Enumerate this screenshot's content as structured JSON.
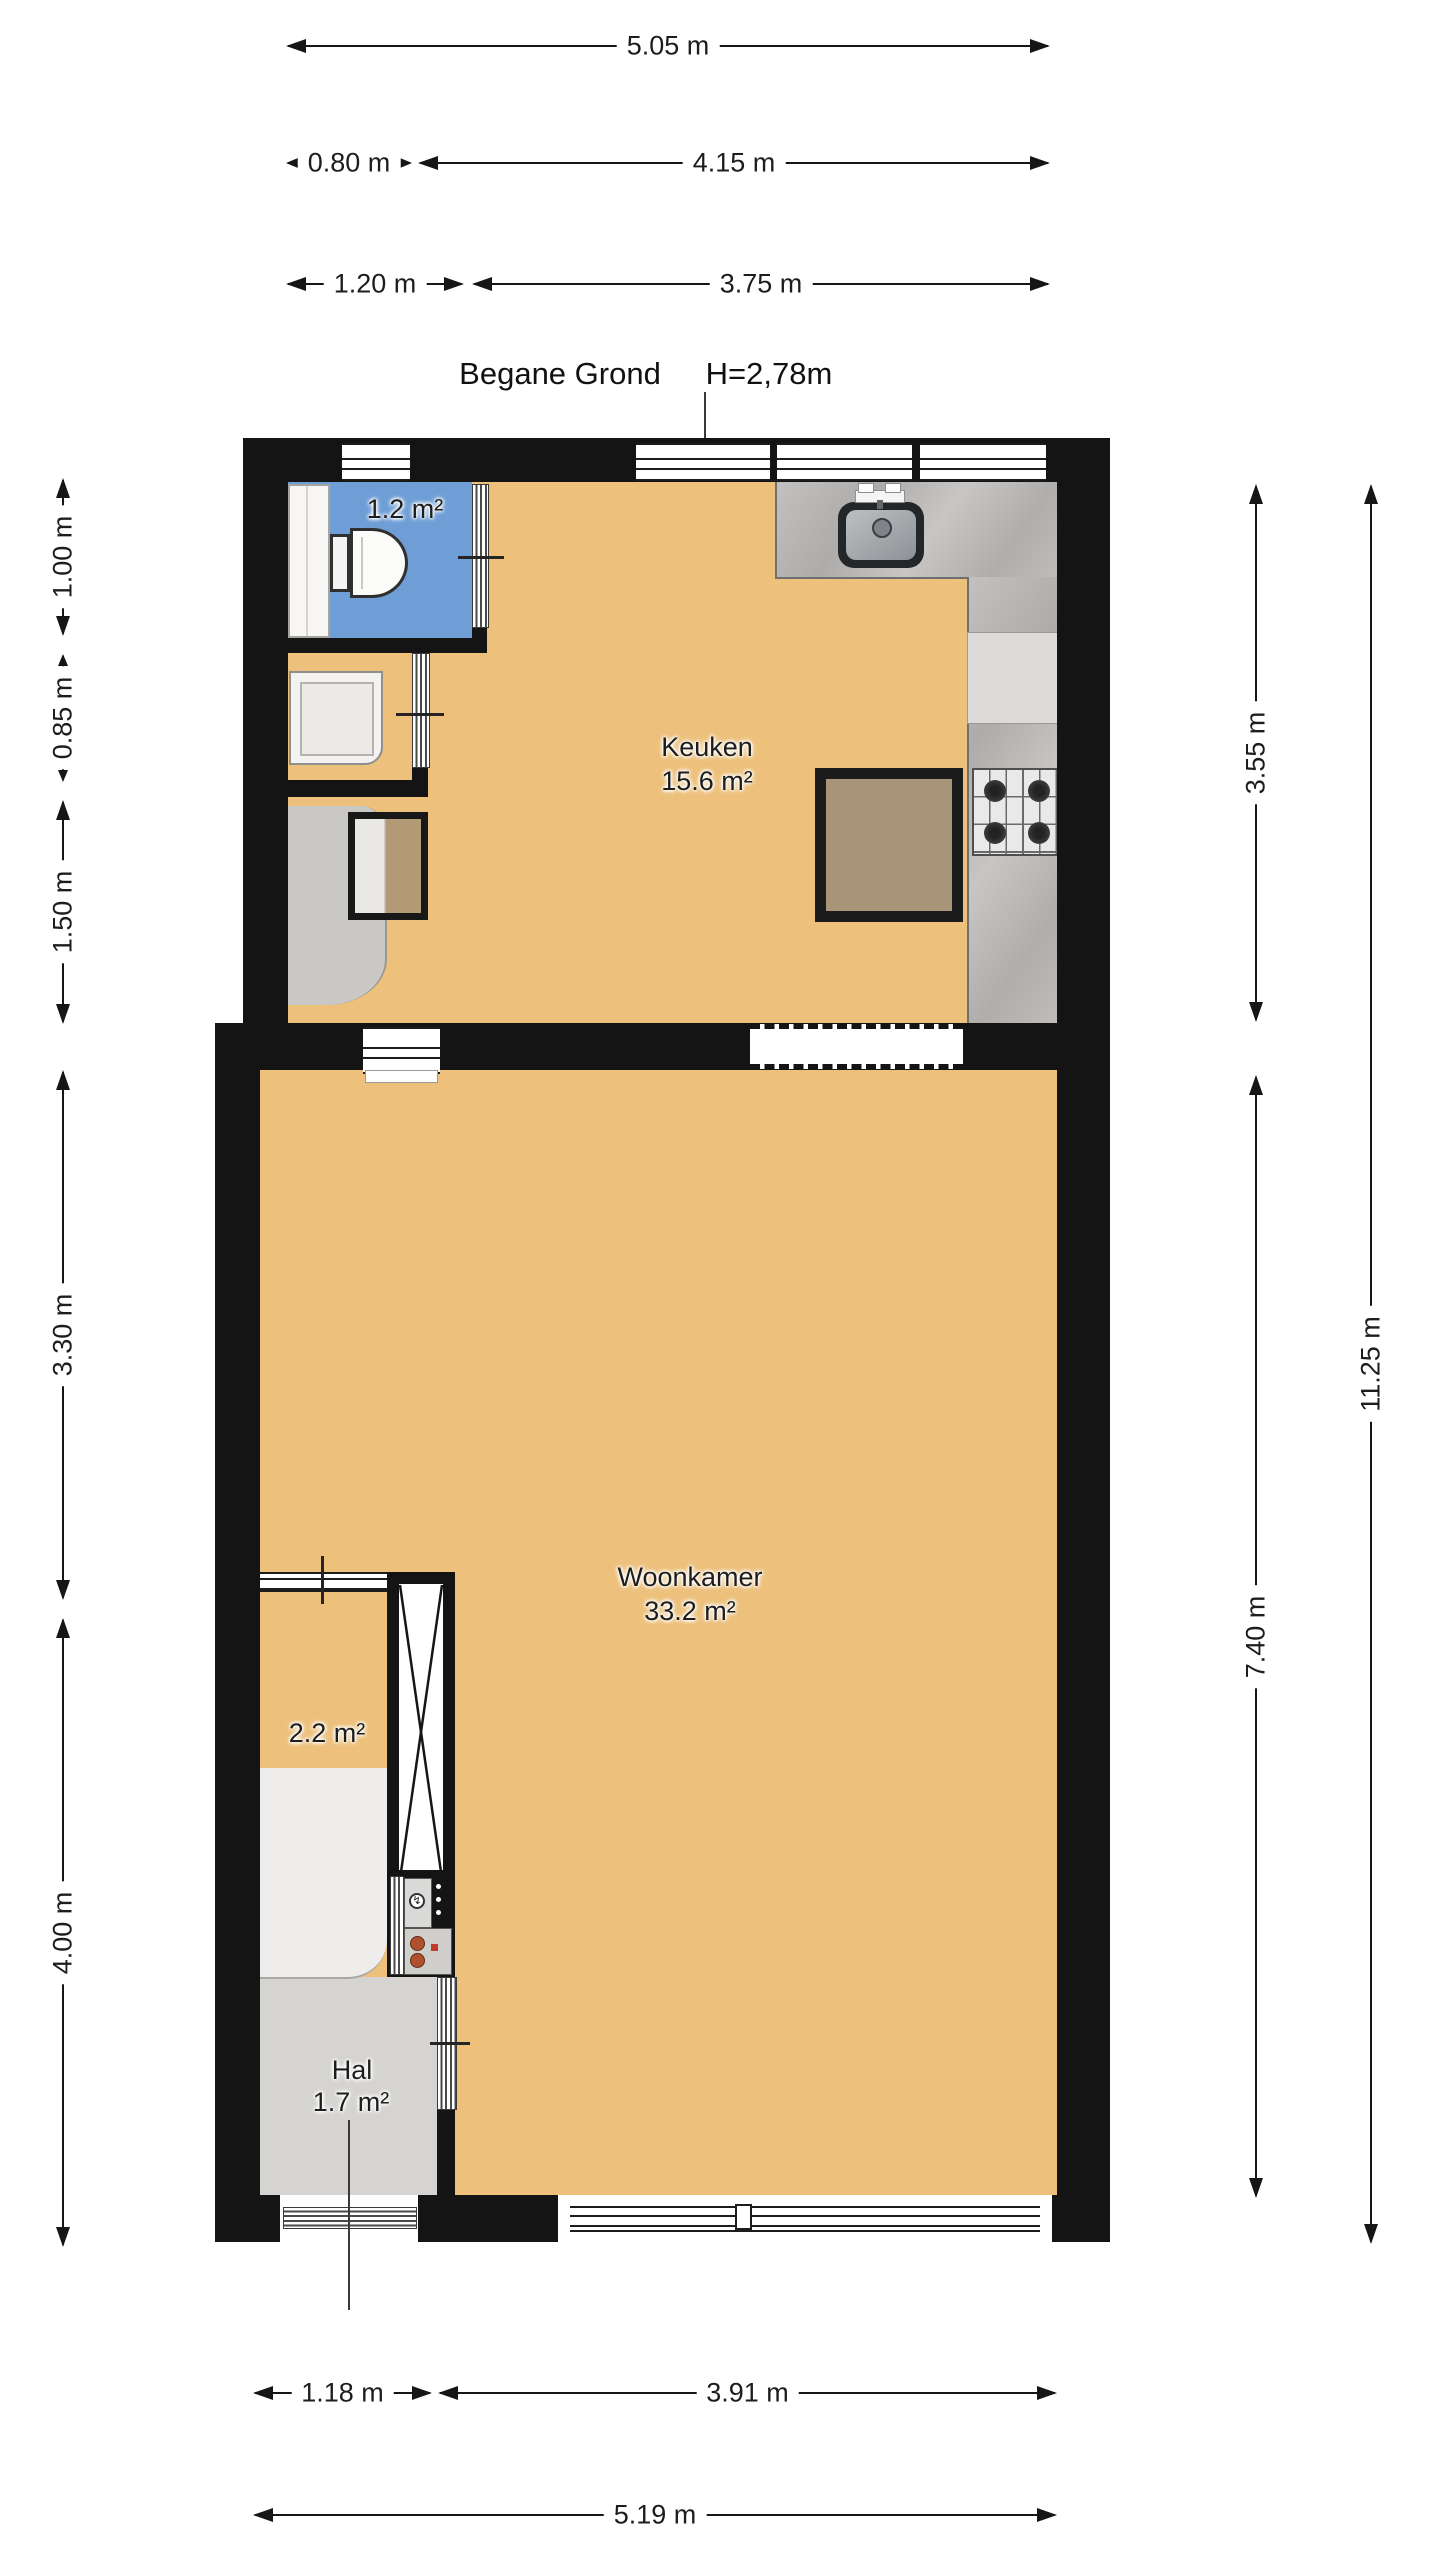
{
  "header": {
    "floor_name": "Begane Grond",
    "ceiling_height": "H=2,78m"
  },
  "rooms": {
    "bathroom": {
      "area": "1.2 m²"
    },
    "kitchen": {
      "name": "Keuken",
      "area": "15.6 m²"
    },
    "living_room": {
      "name": "Woonkamer",
      "area": "33.2 m²"
    },
    "stairs": {
      "area": "2.2 m²"
    },
    "hall": {
      "name": "Hal",
      "area": "1.7 m²"
    }
  },
  "dimensions": {
    "top": [
      {
        "label": "5.05 m"
      },
      {
        "label": "0.80 m"
      },
      {
        "label": "4.15 m"
      },
      {
        "label": "1.20 m"
      },
      {
        "label": "3.75 m"
      }
    ],
    "left": [
      {
        "label": "1.00 m"
      },
      {
        "label": "0.85 m"
      },
      {
        "label": "1.50 m"
      },
      {
        "label": "3.30 m"
      },
      {
        "label": "4.00 m"
      }
    ],
    "right": [
      {
        "label": "3.55 m"
      },
      {
        "label": "7.40 m"
      },
      {
        "label": "11.25 m"
      }
    ],
    "bottom": [
      {
        "label": "1.18 m"
      },
      {
        "label": "3.91 m"
      },
      {
        "label": "5.19 m"
      }
    ]
  },
  "icons": {
    "electric_meter": "↯"
  },
  "colors": {
    "wall": "#141414",
    "floor_orange": "#edc17c",
    "bathroom_blue": "#6f9ed6",
    "floor_gray": "#d6d4d1",
    "counter_gray": "#b5b3b1"
  }
}
